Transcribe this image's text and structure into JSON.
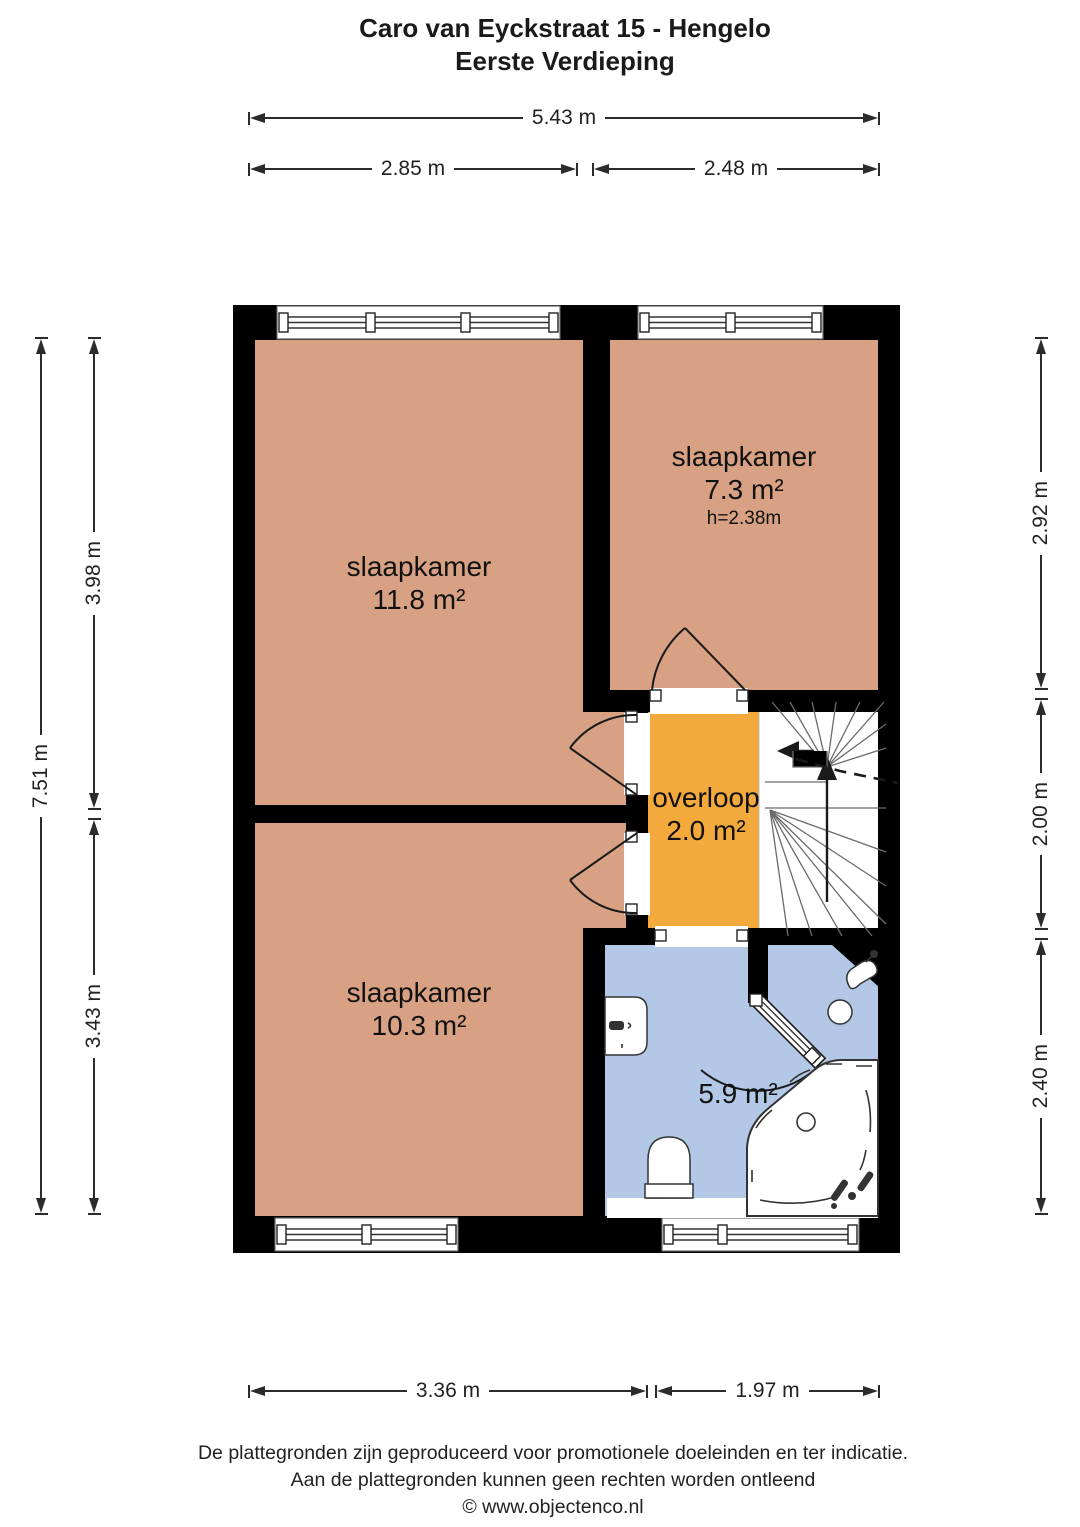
{
  "title": {
    "line1": "Caro van Eyckstraat 15 - Hengelo",
    "line2": "Eerste Verdieping"
  },
  "rooms": {
    "bedroom1": {
      "name": "slaapkamer",
      "area": "11.8 m²"
    },
    "bedroom2": {
      "name": "slaapkamer",
      "area": "7.3 m²",
      "ceiling": "h=2.38m"
    },
    "landing": {
      "name": "overloop",
      "area": "2.0 m²"
    },
    "bedroom3": {
      "name": "slaapkamer",
      "area": "10.3 m²"
    },
    "bathroom": {
      "area": "5.9 m²"
    }
  },
  "dimensions": {
    "top_total": "5.43 m",
    "top_left": "2.85 m",
    "top_right": "2.48 m",
    "left_total": "7.51 m",
    "left_upper": "3.98 m",
    "left_lower": "3.43 m",
    "right_upper": "2.92 m",
    "right_middle": "2.00 m",
    "right_lower": "2.40 m",
    "bottom_left": "3.36 m",
    "bottom_right": "1.97 m"
  },
  "footer": {
    "line1": "De plattegronden zijn geproduceerd voor promotionele doeleinden en ter indicatie.",
    "line2": "Aan de plattegronden kunnen geen rechten worden ontleend",
    "line3": "© www.objectenco.nl"
  },
  "colors": {
    "bedroom_floor": "#d9a183",
    "landing_floor": "#f4a93d",
    "bathroom_floor": "#b2c8e6",
    "wall": "#000000",
    "dimension_line": "#2b2b2b"
  }
}
